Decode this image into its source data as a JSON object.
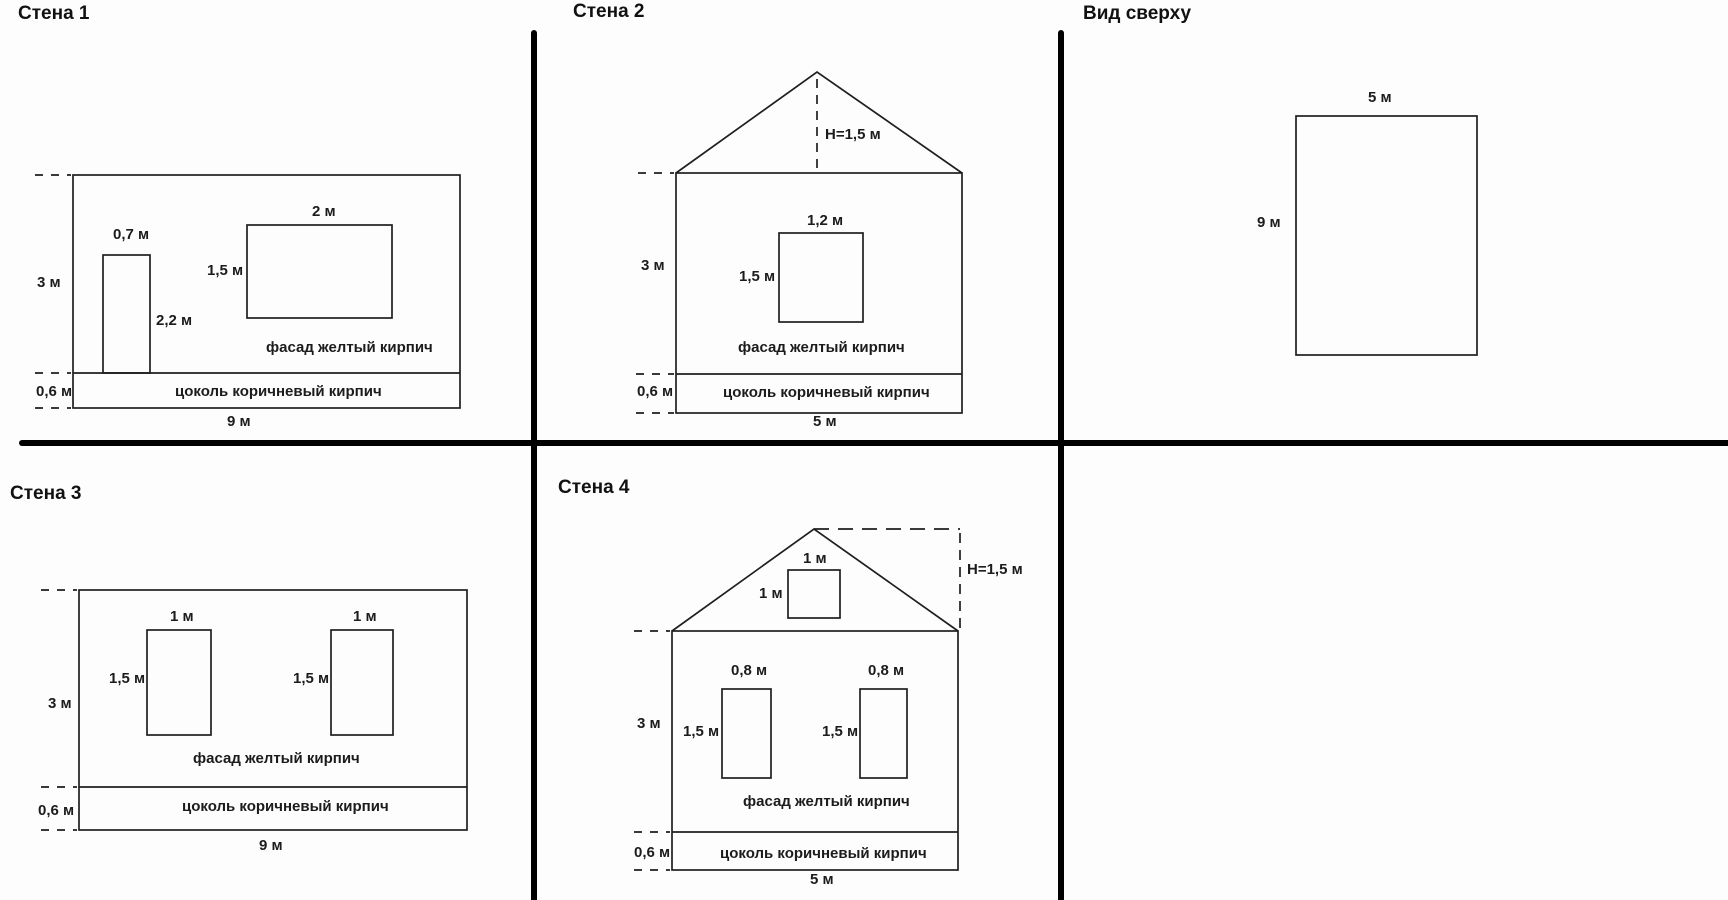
{
  "colors": {
    "line": "#1f1f1f",
    "divider": "#000000",
    "background": "#fdfdfd",
    "text": "#1c1c1c"
  },
  "panels": {
    "wall1": {
      "title": "Стена 1",
      "door_width": "0,7 м",
      "door_height": "2,2 м",
      "window_width": "2 м",
      "window_height": "1,5 м",
      "wall_height": "3 м",
      "plinth_height": "0,6 м",
      "wall_width": "9 м",
      "facade": "фасад желтый кирпич",
      "plinth": "цоколь коричневый кирпич"
    },
    "wall2": {
      "title": "Стена 2",
      "roof_height": "H=1,5 м",
      "window_width": "1,2 м",
      "window_height": "1,5 м",
      "wall_height": "3 м",
      "plinth_height": "0,6 м",
      "wall_width": "5 м",
      "facade": "фасад желтый кирпич",
      "plinth": "цоколь коричневый кирпич"
    },
    "top_view": {
      "title": "Вид сверху",
      "width": "5 м",
      "depth": "9 м"
    },
    "wall3": {
      "title": "Стена 3",
      "window_left_width": "1 м",
      "window_right_width": "1 м",
      "window_left_height": "1,5 м",
      "window_right_height": "1,5 м",
      "wall_height": "3 м",
      "plinth_height": "0,6 м",
      "wall_width": "9 м",
      "facade": "фасад желтый кирпич",
      "plinth": "цоколь коричневый кирпич"
    },
    "wall4": {
      "title": "Стена 4",
      "roof_height": "H=1,5 м",
      "attic_window_width": "1 м",
      "attic_window_height": "1 м",
      "window_left_width": "0,8 м",
      "window_right_width": "0,8 м",
      "window_left_height": "1,5 м",
      "window_right_height": "1,5 м",
      "wall_height": "3 м",
      "plinth_height": "0,6 м",
      "wall_width": "5 м",
      "facade": "фасад желтый кирпич",
      "plinth": "цоколь коричневый кирпич"
    }
  }
}
